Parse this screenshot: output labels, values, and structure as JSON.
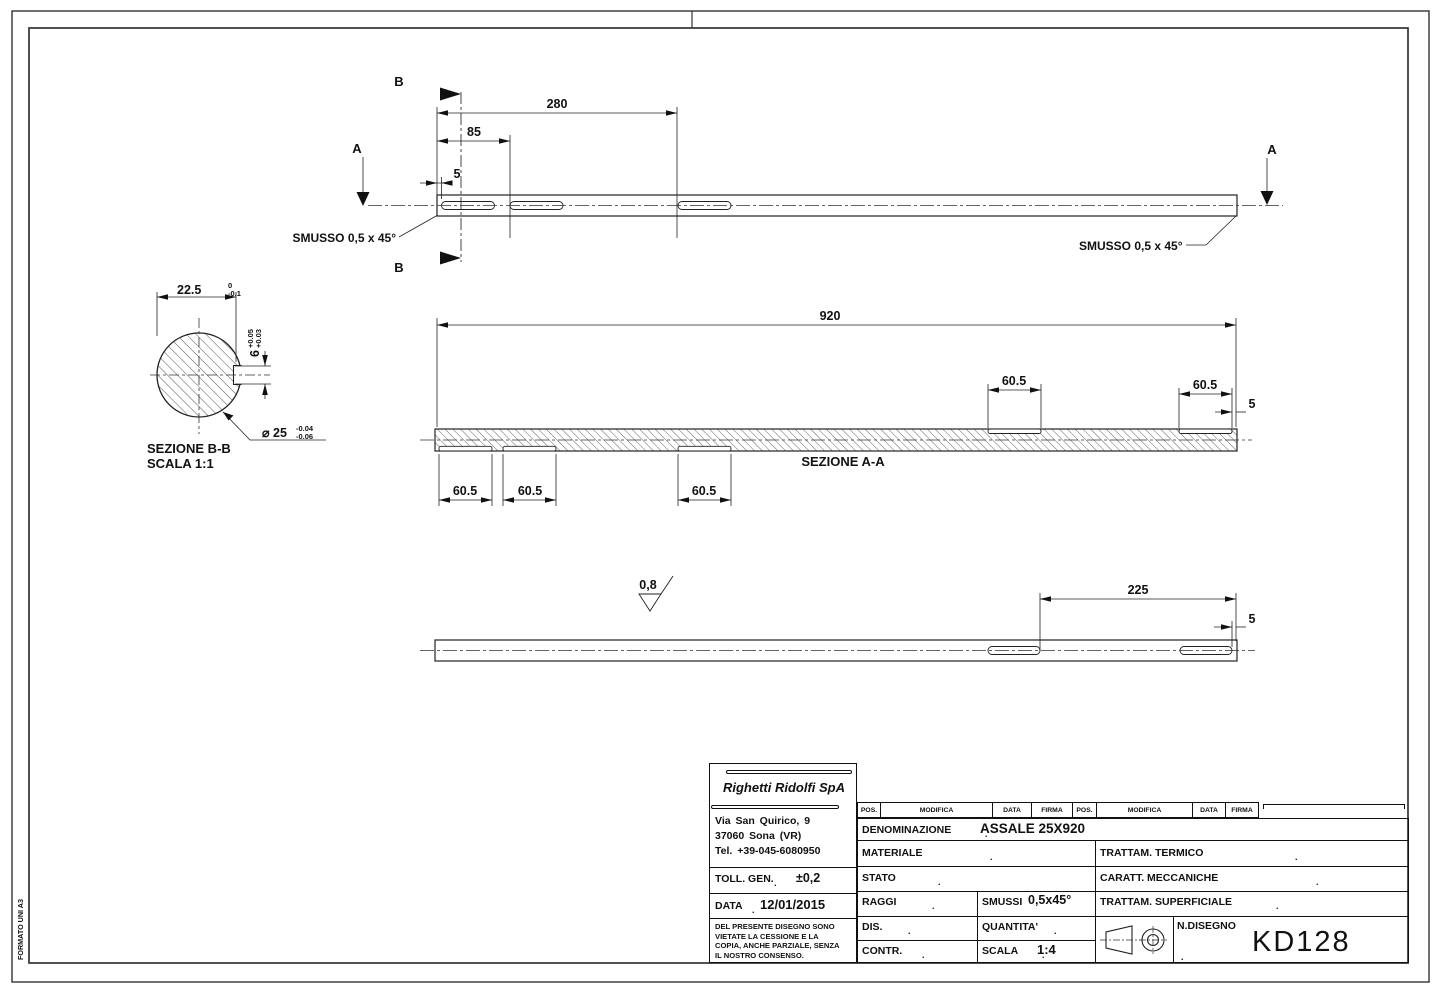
{
  "sheet": {
    "format_label": "FORMATO UNI A3"
  },
  "drawing": {
    "top_view": {
      "cut_b_top": "B",
      "cut_b_bottom": "B",
      "cut_a_left": "A",
      "cut_a_right": "A",
      "dim_280": "280",
      "dim_85": "85",
      "dim_5": "5",
      "smusso_left": "SMUSSO 0,5 x 45°",
      "smusso_right": "SMUSSO 0,5 x 45°"
    },
    "section_bb": {
      "title": "SEZIONE B-B",
      "scale": "SCALA 1:1",
      "dim_width": "22.5",
      "dim_width_tol_up": "0",
      "dim_width_tol_low": "-0.1",
      "dim_key": "6",
      "dim_key_tol_up": "+0.05",
      "dim_key_tol_low": "+0.03",
      "dim_dia": "⌀ 25",
      "dim_dia_tol_up": "-0.04",
      "dim_dia_tol_low": "-0.06"
    },
    "section_aa": {
      "title": "SEZIONE A-A",
      "dim_total": "920",
      "slot_dims": [
        "60.5",
        "60.5",
        "60.5",
        "60.5",
        "60.5"
      ],
      "dim_end_5": "5"
    },
    "bottom_view": {
      "roughness": "0,8",
      "dim_225": "225",
      "dim_5": "5"
    }
  },
  "title_block": {
    "company": "Righetti  Ridolfi  SpA",
    "address_line1": "Via  San  Quirico,  9",
    "address_line2": "37060  Sona  (VR)",
    "address_line3": "Tel.  +39-045-6080950",
    "toll_gen_label": "TOLL. GEN.",
    "toll_gen_value": "±0,2",
    "data_label": "DATA",
    "data_value": "12/01/2015",
    "note_line1": "DEL PRESENTE DISEGNO  SONO",
    "note_line2": "VIETATE  LA  CESSIONE  E LA",
    "note_line3": "COPIA, ANCHE PARZIALE, SENZA",
    "note_line4": "IL    NOSTRO    CONSENSO.",
    "header": {
      "pos1": "POS.",
      "modifica1": "MODIFICA",
      "data1": "DATA",
      "firma1": "FIRMA",
      "pos2": "POS.",
      "modifica2": "MODIFICA",
      "data2": "DATA",
      "firma2": "FIRMA"
    },
    "denominazione_label": "DENOMINAZIONE",
    "denominazione_value": "ASSALE 25X920",
    "materiale_label": "MATERIALE",
    "trattam_termico_label": "TRATTAM. TERMICO",
    "stato_label": "STATO",
    "caratt_meccaniche_label": "CARATT. MECCANICHE",
    "raggi_label": "RAGGI",
    "smussi_label": "SMUSSI",
    "smussi_value": "0,5x45°",
    "trattam_superficiale_label": "TRATTAM. SUPERFICIALE",
    "dis_label": "DIS.",
    "quantita_label": "QUANTITA'",
    "ndisegno_label": "N.DISEGNO",
    "ndisegno_value": "KD128",
    "contr_label": "CONTR.",
    "scala_label": "SCALA",
    "scala_value": "1:4",
    "dot": "."
  }
}
